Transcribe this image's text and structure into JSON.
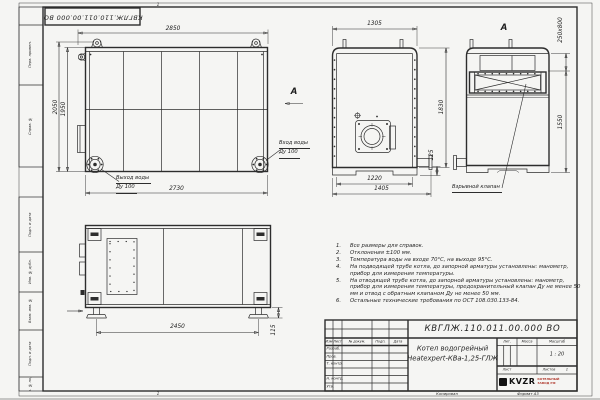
{
  "doc_number": "КВГЛЖ.110.011.00.000 ВО",
  "zones": {
    "top": "1",
    "bottom": "1"
  },
  "margin_fields": [
    "Перв. примен.",
    "Справ. №",
    "Подп. и дата",
    "Инв. № дубл.",
    "Взам. инв. №",
    "Подп. и дата",
    "Инв. № подл."
  ],
  "dims": {
    "side_top": "2850",
    "side_h_outer": "2050",
    "side_h_inner": "1950",
    "side_bottom": "2730",
    "front_top": "1305",
    "front_h": "1830",
    "front_pipe": "125",
    "front_b1": "1220",
    "front_b2": "1405",
    "rear_valve": "250x800",
    "rear_h": "1550",
    "plan_w": "2450",
    "plan_h": "115"
  },
  "labels": {
    "outlet1": "Выход воды",
    "outlet2": "Ду 100",
    "inlet1": "Вход воды",
    "inlet2": "Ду 100",
    "view_arrow": "А",
    "rear_view": "А",
    "valve_callout": "Взрывной клапан"
  },
  "notes": [
    {
      "n": "1.",
      "t": "Все размеры для справок."
    },
    {
      "n": "2.",
      "t": "Отклонения ±100 мм."
    },
    {
      "n": "3.",
      "t": "Температура воды на входе 70°С, на выходе 95°С."
    },
    {
      "n": "4.",
      "t": "На подводящей трубе котла, до запорной арматуры установлены: манометр, прибор для измерения температуры."
    },
    {
      "n": "5.",
      "t": "На отводящей трубе котла, до запорной арматуры установлены: манометр, прибор для измерения температуры, предохранительный клапан Ду не менее 50 мм и отвод с обратным клапаном Ду не менее 50 мм."
    },
    {
      "n": "6.",
      "t": "Остальные технические требования по ОСТ 108.030.133-84."
    }
  ],
  "title_block": {
    "product_line1": "Котел водогрейный",
    "product_line2": "Heatexpert-КВа-1,25-ГЛЖ",
    "col_izm": "Изм",
    "col_list": "Лист",
    "col_doc": "№ докум.",
    "col_sign": "Подп.",
    "col_date": "Дата",
    "row_razrab": "Разраб.",
    "row_prov": "Пров.",
    "row_tkontr": "Т. контр.",
    "row_nkontr": "Н. контр.",
    "row_utv": "Утв.",
    "lit_label": "Лит.",
    "mass_label": "Масса",
    "scale_label": "Масштаб",
    "scale_value": "1 : 20",
    "sheet_label": "Лист",
    "sheets_label": "Листов",
    "sheets_value": "1",
    "logo_text": "KVZR",
    "logo_sub1": "КОТЕЛЬНЫЙ",
    "logo_sub2": "ЗАВОД РФ",
    "footer_copy": "Копировал",
    "footer_format": "Формат А3"
  },
  "colors": {
    "paper": "#f5f5f3",
    "line": "#2d2d2d",
    "logo_red": "#b03a2e",
    "logo_black": "#111111"
  }
}
